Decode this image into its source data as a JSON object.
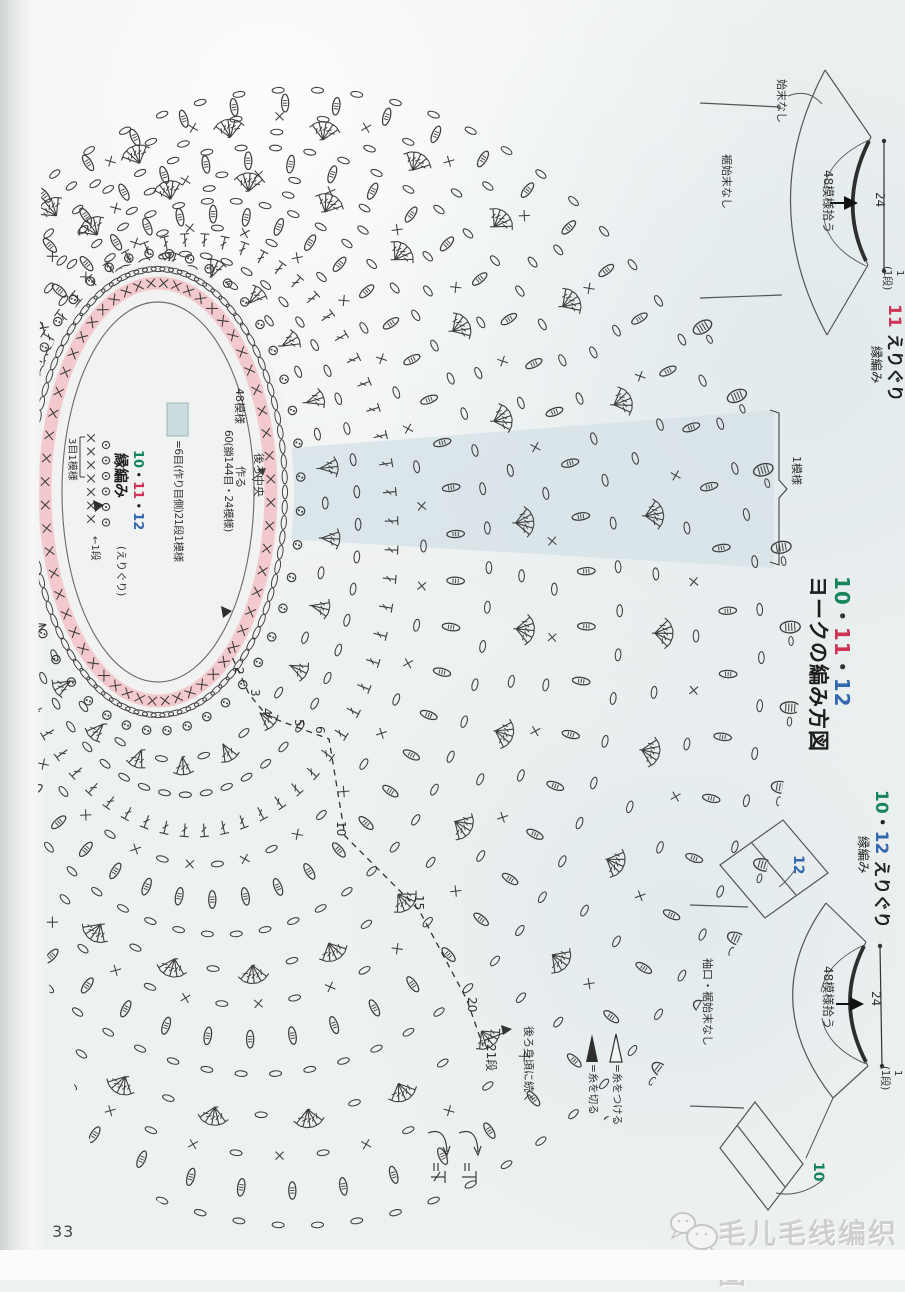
{
  "colors": {
    "green": "#17855c",
    "red": "#ce3355",
    "blue": "#3468ae",
    "ink": "#3e3e3e",
    "pink": "#f3c9cd",
    "wedge": "#d7e3e7"
  },
  "page": {
    "number": "33",
    "watermark": "毛儿毛线编织圈"
  },
  "main_title": {
    "nums": [
      "10",
      "11",
      "12"
    ],
    "sep": "・",
    "text": "ヨークの編み方図"
  },
  "chart": {
    "pattern_bracket": "1模様",
    "row21": "21段",
    "continue_note": "後ろ身頃に続く",
    "neck_labels": {
      "patterns": "48模様",
      "cast_on": "60(鎖144目・24模様)",
      "make": "作る",
      "back_center": "後ろ中央"
    },
    "swatch_note": "=6目(作り目側)21段1模様",
    "edging": {
      "nums": [
        "10",
        "11",
        "12"
      ],
      "sep": "・",
      "label": "縁編み",
      "scope": "(えりぐり)",
      "unit": "3目1模様",
      "row1": "←1段"
    },
    "legend": {
      "attach": "=糸をつける",
      "cut": "=糸を切る"
    }
  },
  "schematic_top": {
    "num": "11",
    "title": "えりぐり",
    "subtitle": "縁編み",
    "dim": "24",
    "one": "1",
    "one_row": "(1段)",
    "pickup": "48模様拾う",
    "no_finish": "始末なし",
    "hem_no_finish": "裾始末なし"
  },
  "schematic_mid": {
    "num_green": "10",
    "num_blue": "12",
    "sep": "・",
    "title": "えりぐり",
    "subtitle": "縁編み",
    "dim": "24",
    "one": "1",
    "one_row": "(1段)",
    "pickup": "48模様拾う",
    "cuff_hem": "袖口・裾始末なし",
    "sleeve_label": "12",
    "bottom_label": "10"
  },
  "render": {
    "stroke": "#3e3e3e",
    "neck": {
      "cx": 158,
      "cy": 492,
      "inner": [
        96,
        190
      ],
      "pink": [
        113,
        209
      ],
      "chain": [
        127,
        223
      ],
      "bead": [
        143,
        239
      ],
      "white": [
        136,
        232
      ]
    },
    "outer": {
      "cx": 310,
      "cy": 672,
      "rx": 495,
      "ry": 600
    },
    "rings": [
      {
        "t": 0.12,
        "type": "fan",
        "k": 3,
        "n": 22,
        "off": 0.1
      },
      {
        "t": 0.18,
        "type": "chain",
        "n": 52,
        "off": 0.0
      },
      {
        "t": 0.24,
        "type": "dc",
        "n": 64,
        "off": 0.05
      },
      {
        "t": 0.3,
        "type": "chainx",
        "n": 50,
        "off": 0.0
      },
      {
        "t": 0.36,
        "type": "leaf",
        "n": 46,
        "off": 0.07
      },
      {
        "t": 0.42,
        "type": "chain",
        "n": 58,
        "off": 0.0
      },
      {
        "t": 0.48,
        "type": "fan",
        "k": 5,
        "n": 23,
        "off": 0.13
      },
      {
        "t": 0.54,
        "type": "chainx",
        "n": 54,
        "off": 0.0
      },
      {
        "t": 0.6,
        "type": "leaf",
        "n": 50,
        "off": 0.06
      },
      {
        "t": 0.66,
        "type": "chain",
        "n": 66,
        "off": 0.0
      },
      {
        "t": 0.73,
        "type": "fan",
        "k": 5,
        "n": 26,
        "off": 0.02
      },
      {
        "t": 0.8,
        "type": "chainx",
        "n": 60,
        "off": 0.0
      },
      {
        "t": 0.86,
        "type": "leaf",
        "n": 54,
        "off": 0.05
      },
      {
        "t": 0.92,
        "type": "chain",
        "n": 74,
        "off": 0.0
      },
      {
        "t": 0.975,
        "type": "puff",
        "n": 46,
        "off": 0.068
      }
    ],
    "row_numbers": [
      {
        "n": "2",
        "x": 237,
        "y": 670
      },
      {
        "n": "3",
        "x": 253,
        "y": 692
      },
      {
        "n": "4",
        "x": 265,
        "y": 711
      },
      {
        "n": "5",
        "x": 297,
        "y": 722
      },
      {
        "n": "6",
        "x": 318,
        "y": 729
      },
      {
        "n": "10",
        "x": 339,
        "y": 824
      },
      {
        "n": "15",
        "x": 417,
        "y": 898
      },
      {
        "n": "20",
        "x": 470,
        "y": 1000
      }
    ]
  }
}
